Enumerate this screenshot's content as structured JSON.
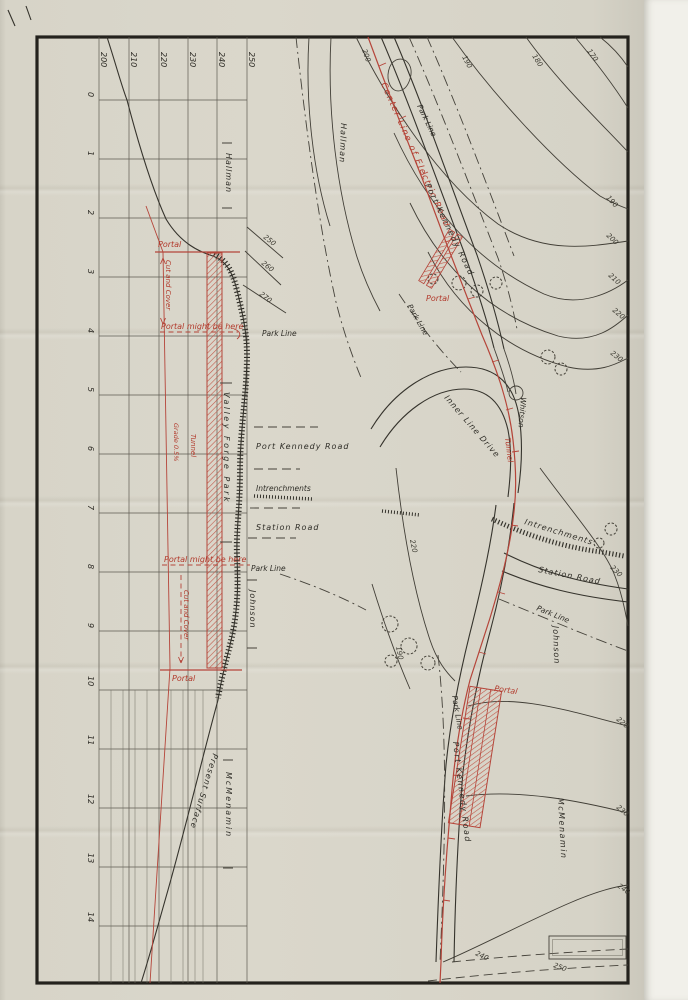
{
  "sheet": {
    "profile": {
      "station_labels": [
        "0",
        "1",
        "2",
        "3",
        "4",
        "5",
        "6",
        "7",
        "8",
        "9",
        "10",
        "11",
        "12",
        "13",
        "14"
      ],
      "elevation_labels": [
        "200",
        "210",
        "220",
        "230",
        "240",
        "250"
      ],
      "portal_top": "Portal",
      "cut_and_cover_top": "Cut and Cover",
      "portal_might_top": "Portal might be here",
      "grade": "Grade 0.5%",
      "tunnel": "Tunnel",
      "portal_might_bottom": "Portal might be here",
      "cut_and_cover_bottom": "Cut and Cover",
      "portal_bottom": "Portal",
      "hallman": "Hallman",
      "park_line_top": "Park Line",
      "valley_forge_park": "Valley Forge Park",
      "port_kennedy_road": "Port Kennedy Road",
      "intrenchments": "Intrenchments",
      "station_road": "Station Road",
      "park_line_bottom": "Park Line",
      "johnson": "Johnson",
      "present_surface": "Present Surface",
      "mcmenamin": "McMenamin"
    },
    "plan": {
      "center_line": "Center Line of Electric Road",
      "portal_top": "Portal",
      "tunnel": "Tunnel",
      "portal_bottom": "Portal",
      "hallman": "Hallman",
      "whitson": "Whitson",
      "johnson": "Johnson",
      "mcmenamin": "McMenamin",
      "park_line_top": "Park Line",
      "port_kennedy_road_top": "Port Kennedy Road",
      "park_line_mid": "Park Line",
      "inner_line_drive": "Inner Line Drive",
      "intrenchments": "Intrenchments",
      "station_road": "Station Road",
      "park_line_se": "Park Line",
      "park_line_bottom": "Park Line",
      "port_kennedy_road_bottom": "Port Kennedy Road",
      "contours": [
        "200",
        "190",
        "180",
        "170",
        "250",
        "260",
        "270",
        "190",
        "200",
        "210",
        "220",
        "230",
        "220",
        "230",
        "190",
        "220",
        "230",
        "240",
        "240",
        "250"
      ]
    },
    "colors": {
      "ink": "#2f2d28",
      "red": "#b5453a",
      "paper": "#d8d5c9"
    }
  }
}
